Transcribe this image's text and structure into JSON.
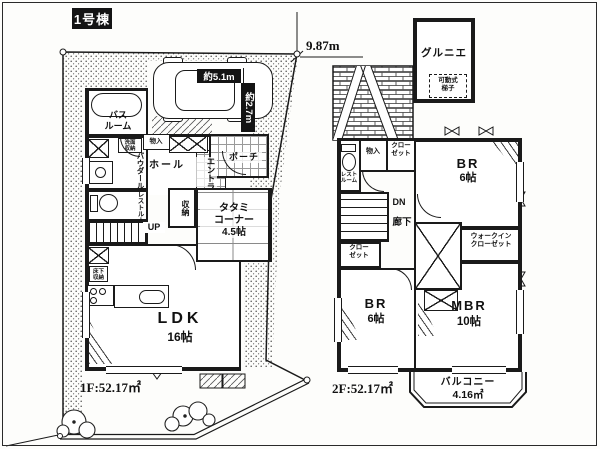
{
  "title": "1号棟",
  "colors": {
    "ink": "#1a1a1a",
    "paper": "#ffffff"
  },
  "dimensions": {
    "site_width": "9.87m",
    "car_length": "約5.1m",
    "car_depth": "約2.7m"
  },
  "floor1": {
    "area": "1F:52.17㎡",
    "bath": [
      "バス",
      "ルーム"
    ],
    "powder_room": "パウダールーム",
    "washstand_storage": [
      "洗面",
      "収納"
    ],
    "restroom": "レストルーム",
    "storage_small": "物入",
    "hall": "ホール",
    "entrance": "エントランス",
    "porch": "ポーチ",
    "closet": "収納",
    "tatami": [
      "タタミ",
      "コーナー",
      "4.5帖"
    ],
    "stairs_up": "UP",
    "underfloor_storage": [
      "床下",
      "収納"
    ],
    "ldk": [
      "LDK",
      "16帖"
    ]
  },
  "floor2": {
    "area": "2F:52.17㎡",
    "grenier": "グルニエ",
    "ladder": [
      "可動式",
      "梯子"
    ],
    "restroom": [
      "レスト",
      "ルーム"
    ],
    "storage_small": "物入",
    "closet_top": [
      "クロー",
      "ゼット"
    ],
    "bedroom_top": [
      "BR",
      "6帖"
    ],
    "stairs_down": "DN",
    "hallway": "廊下",
    "closet_mid": [
      "クロー",
      "ゼット"
    ],
    "walkin_closet": [
      "ウォークイン",
      "クローゼット"
    ],
    "bedroom_bottom": [
      "BR",
      "6帖"
    ],
    "master_bedroom": [
      "MBR",
      "10帖"
    ],
    "balcony": [
      "バルコニー",
      "4.16㎡"
    ]
  }
}
